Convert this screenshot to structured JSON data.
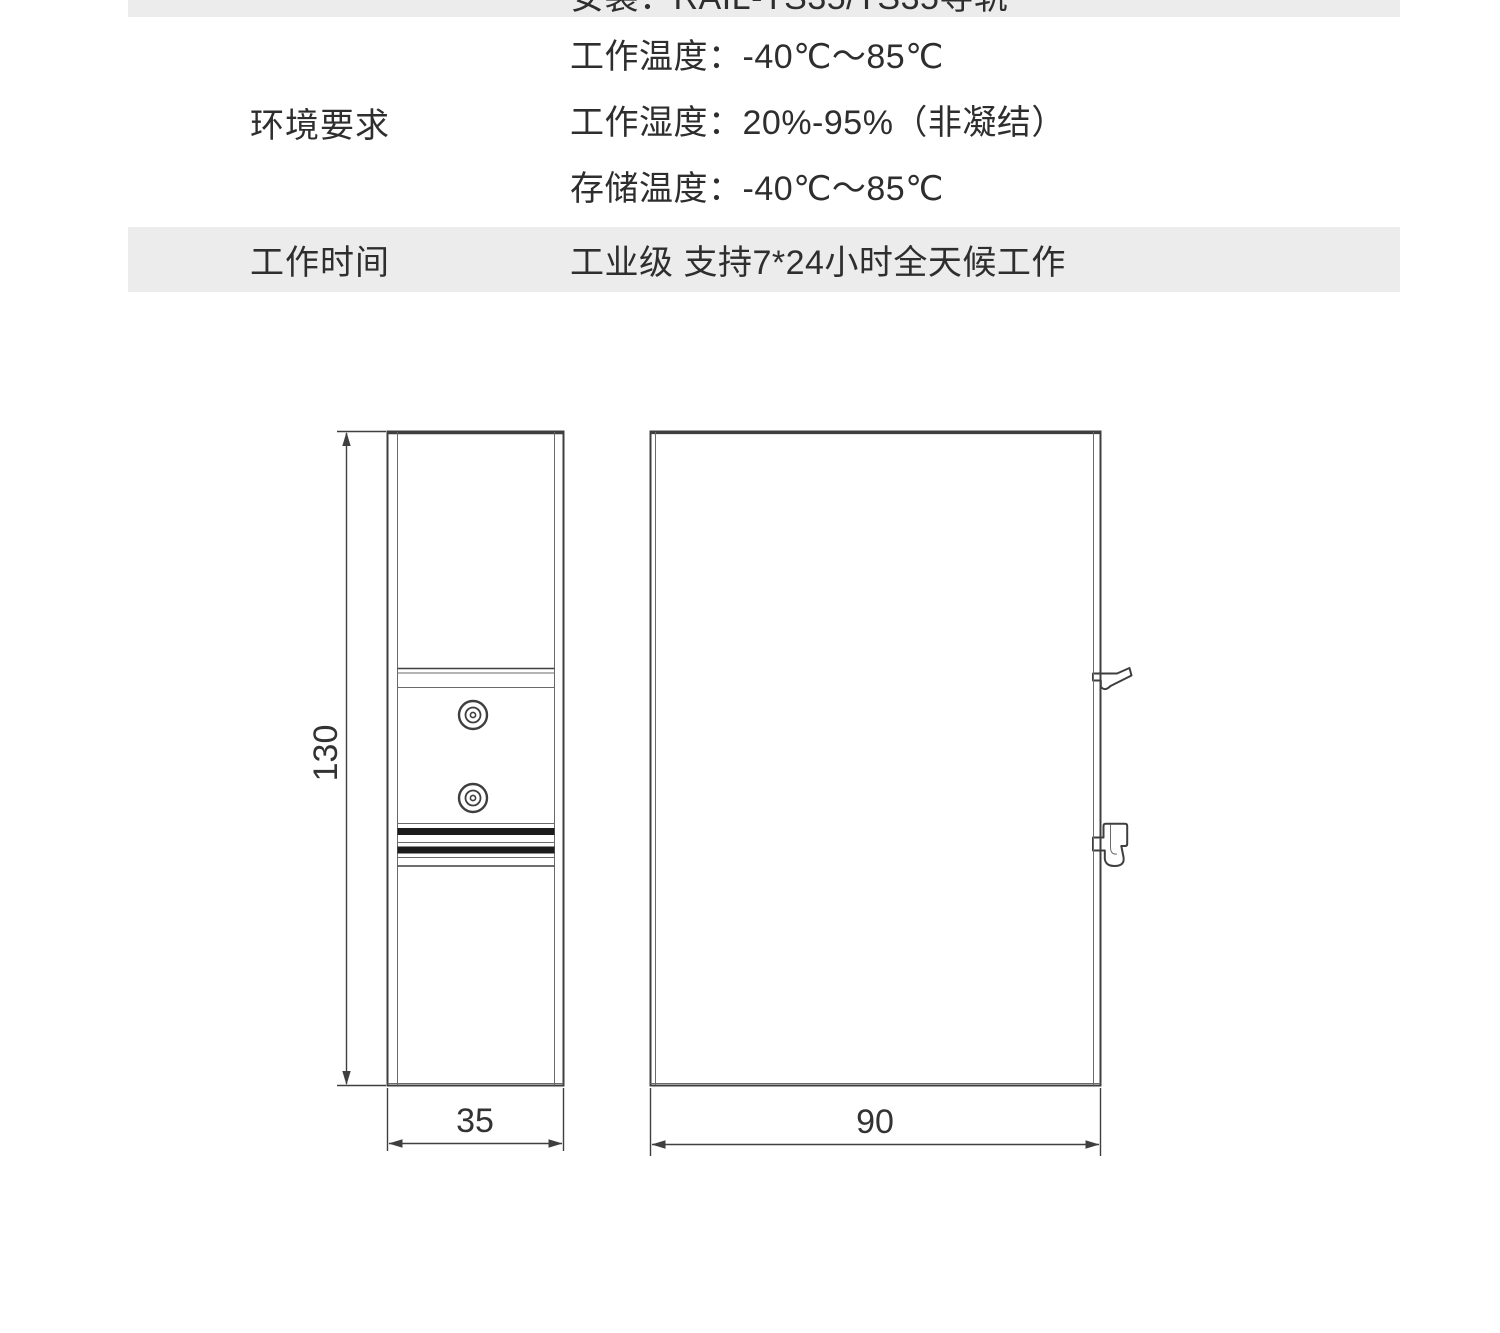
{
  "page": {
    "background": "#ffffff"
  },
  "spec_table": {
    "stripe_color": "#ececec",
    "text_color": "#2e2e2e",
    "rows": [
      {
        "label": "",
        "values": [
          "安装：RAIL-TS35/TS35导轨"
        ]
      },
      {
        "label": "环境要求",
        "values": [
          "工作温度：-40℃～85℃",
          "工作湿度：20%-95%（非凝结）",
          "存储温度：-40℃～85℃"
        ]
      },
      {
        "label": "工作时间",
        "values": [
          "工业级 支持7*24小时全天候工作"
        ]
      }
    ]
  },
  "drawings": {
    "line_color": "#3f3f3f",
    "side_view": {
      "height_dim": "130",
      "width_dim": "35"
    },
    "front_view": {
      "width_dim": "90"
    }
  }
}
